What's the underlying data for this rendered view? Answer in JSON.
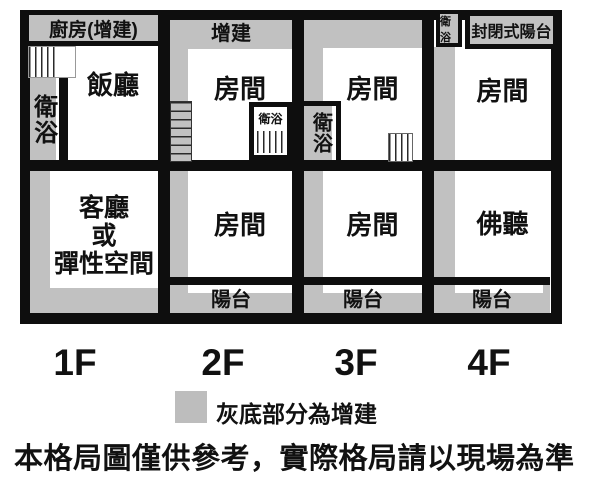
{
  "colors": {
    "addition_gray": "#c1c1c1",
    "wall_black": "#0e0e0e"
  },
  "floor1": {
    "label": "1F",
    "kitchen": "廚房(增建)",
    "bathroom": "衛浴",
    "dining": "飯廳",
    "living_line1": "客廳",
    "living_line2": "或",
    "living_line3": "彈性空間"
  },
  "floor2": {
    "label": "2F",
    "addition": "增建",
    "room_upper": "房間",
    "bathroom": "衛浴",
    "room_lower": "房間",
    "balcony": "陽台"
  },
  "floor3": {
    "label": "3F",
    "room_upper": "房間",
    "bathroom": "衛浴",
    "room_lower": "房間",
    "balcony": "陽台"
  },
  "floor4": {
    "label": "4F",
    "bathroom": "衛浴",
    "enclosed_balcony": "封閉式陽台",
    "room_upper": "房間",
    "hall": "佛聽",
    "balcony": "陽台"
  },
  "legend": {
    "label": "灰底部分為增建"
  },
  "disclaimer": "本格局圖僅供參考，實際格局請以現場為準"
}
